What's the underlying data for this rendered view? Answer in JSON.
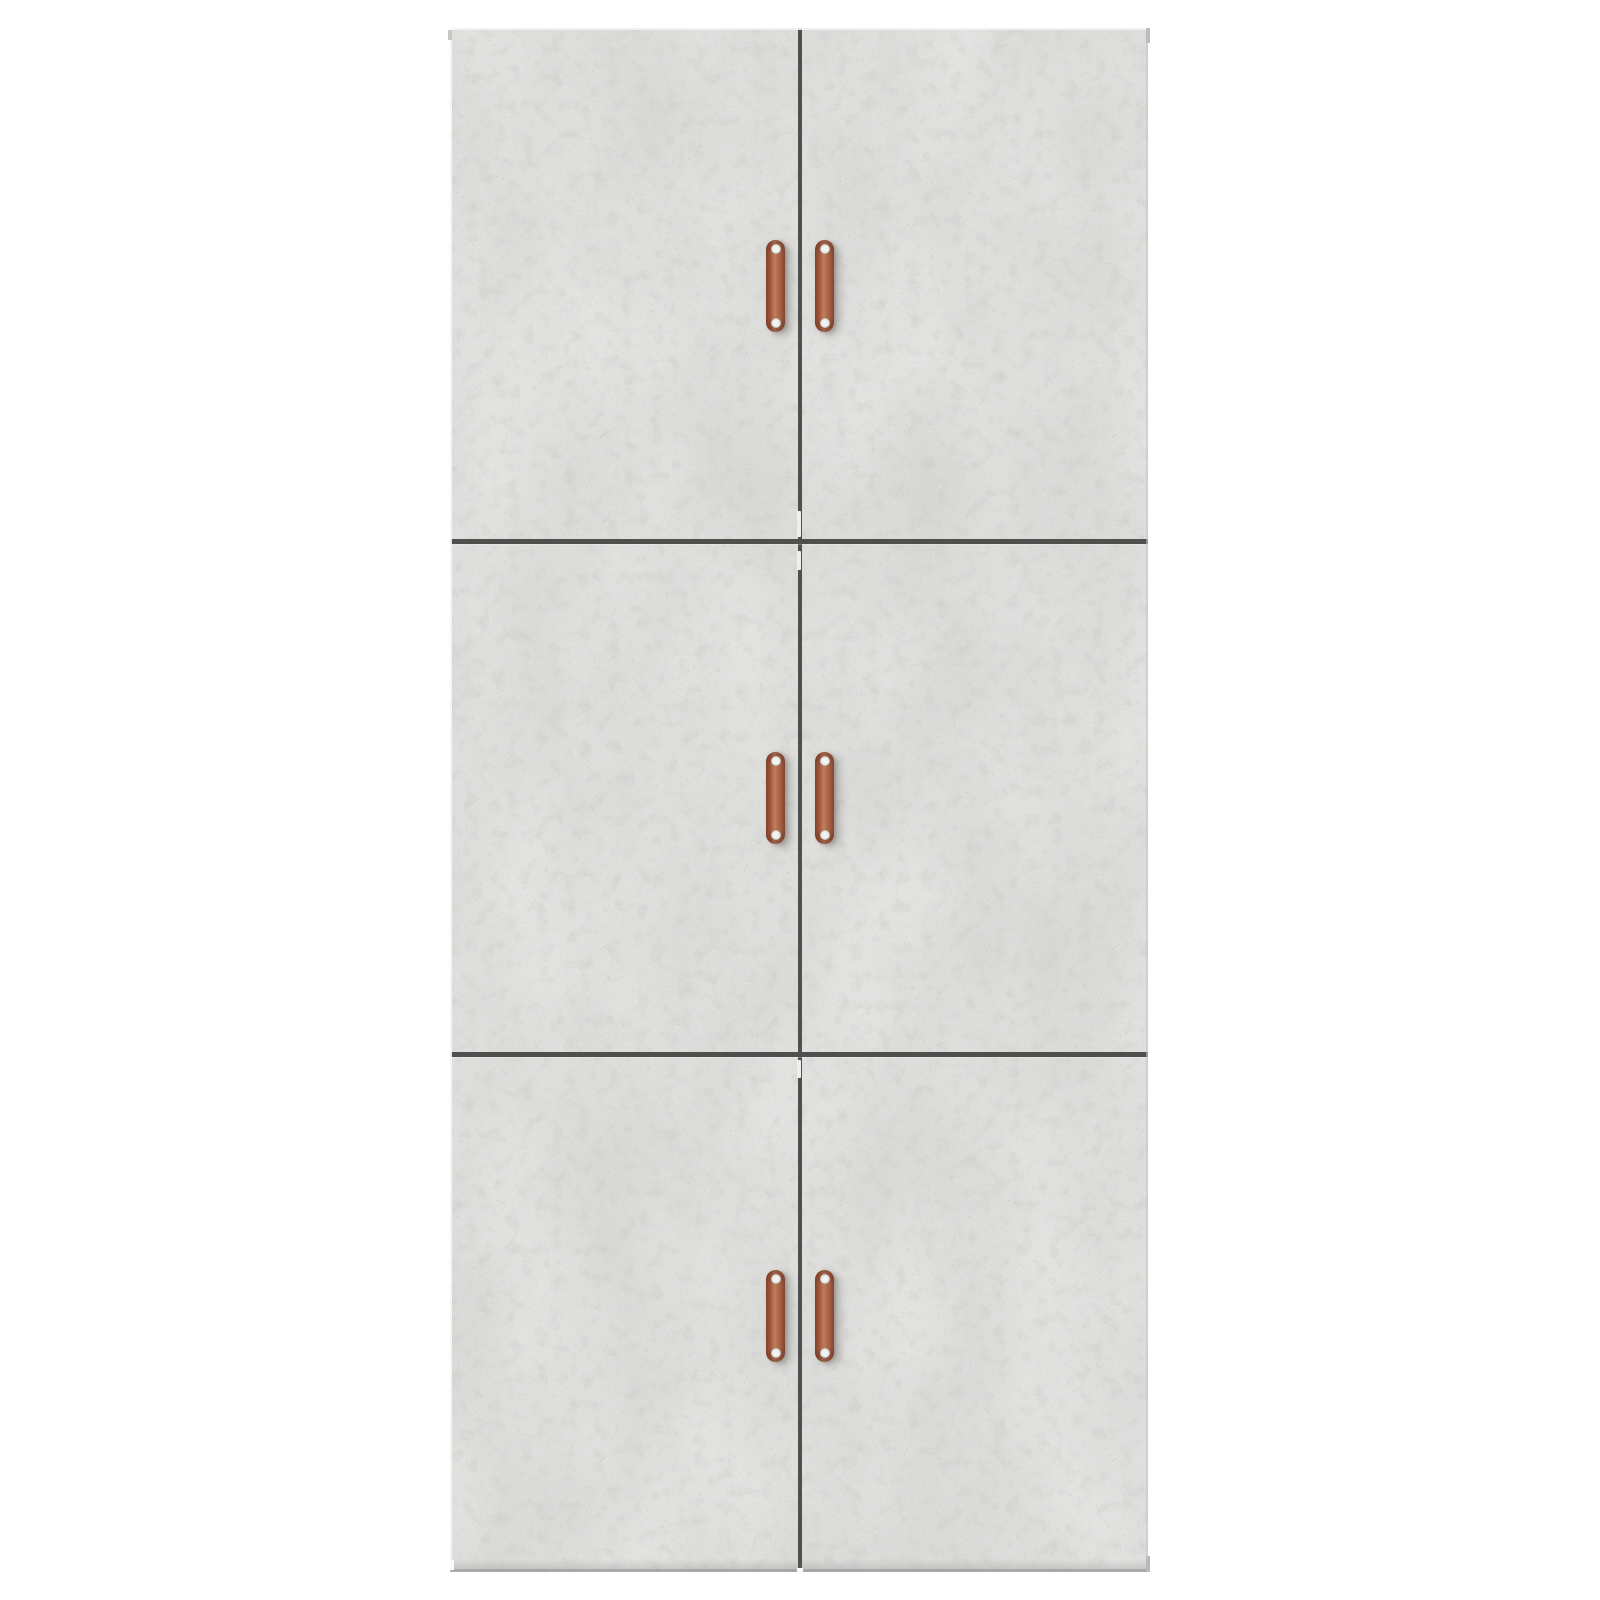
{
  "scene": {
    "description": "Product photo of a tall gray concrete-effect cabinet with six doors in a two-column, three-row grid, each door fitted with a vertical copper strap handle, shown on a plain white background"
  },
  "cabinet": {
    "finish": "concrete gray",
    "rows": 3,
    "columns": 2,
    "door_count": 6,
    "handle_count": 6,
    "screws_per_handle": 2,
    "doors": [
      {
        "id": "top-left"
      },
      {
        "id": "top-right"
      },
      {
        "id": "middle-left"
      },
      {
        "id": "middle-right"
      },
      {
        "id": "bottom-left"
      },
      {
        "id": "bottom-right"
      }
    ]
  },
  "colors": {
    "background": "#ffffff",
    "concrete_base": "#d6d6d4",
    "concrete_speck": "#8f8f8d",
    "seam": "#4f4f4d",
    "edge_highlight": "#efefed",
    "copper_light": "#c17e60",
    "copper_mid": "#a55d43",
    "copper_dark": "#7d452f",
    "screw": "#f3f3f1"
  }
}
